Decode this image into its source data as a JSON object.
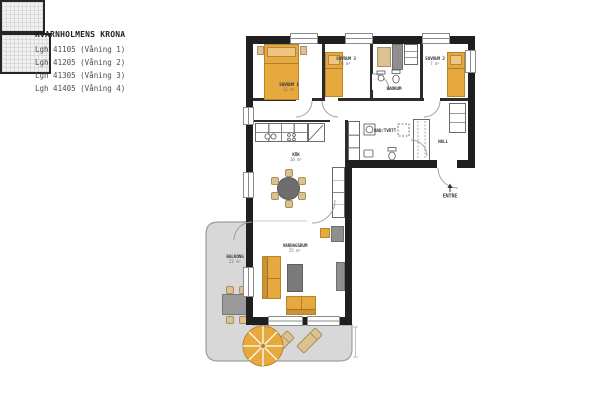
{
  "title_block": {
    "title": "KVARNHOLMENS KRONA",
    "apartments": [
      "Lgh 41105 (Våning 1)",
      "Lgh 41205 (Våning 2)",
      "Lgh 41305 (Våning 3)",
      "Lgh 41405 (Våning 4)"
    ]
  },
  "floorplan": {
    "rooms": {
      "sovrum1": {
        "name": "SOVRUM 1",
        "area": "12 m²"
      },
      "sovrum3": {
        "name": "SOVRUM 3",
        "area": "8 m²"
      },
      "sovrum2": {
        "name": "SOVRUM 2",
        "area": "7 m²"
      },
      "badrum": {
        "name": "BADRUM",
        "area": ""
      },
      "badrum_tvatt": {
        "name": "BAD/TVÄTT",
        "area": ""
      },
      "hall": {
        "name": "HALL",
        "area": ""
      },
      "kok": {
        "name": "KÖK",
        "area": "10 m²"
      },
      "vardagsrum": {
        "name": "VARDAGSRUM",
        "area": "25 m²"
      },
      "balkong": {
        "name": "BALKONG",
        "area": "22 m²"
      }
    },
    "entrance_label": "ENTRE",
    "colors": {
      "furniture_orange": "#E7A83E",
      "wood_tan": "#DCC191",
      "balcony_gray": "#D8D8D8",
      "wall_black": "#1F1F1F"
    }
  }
}
